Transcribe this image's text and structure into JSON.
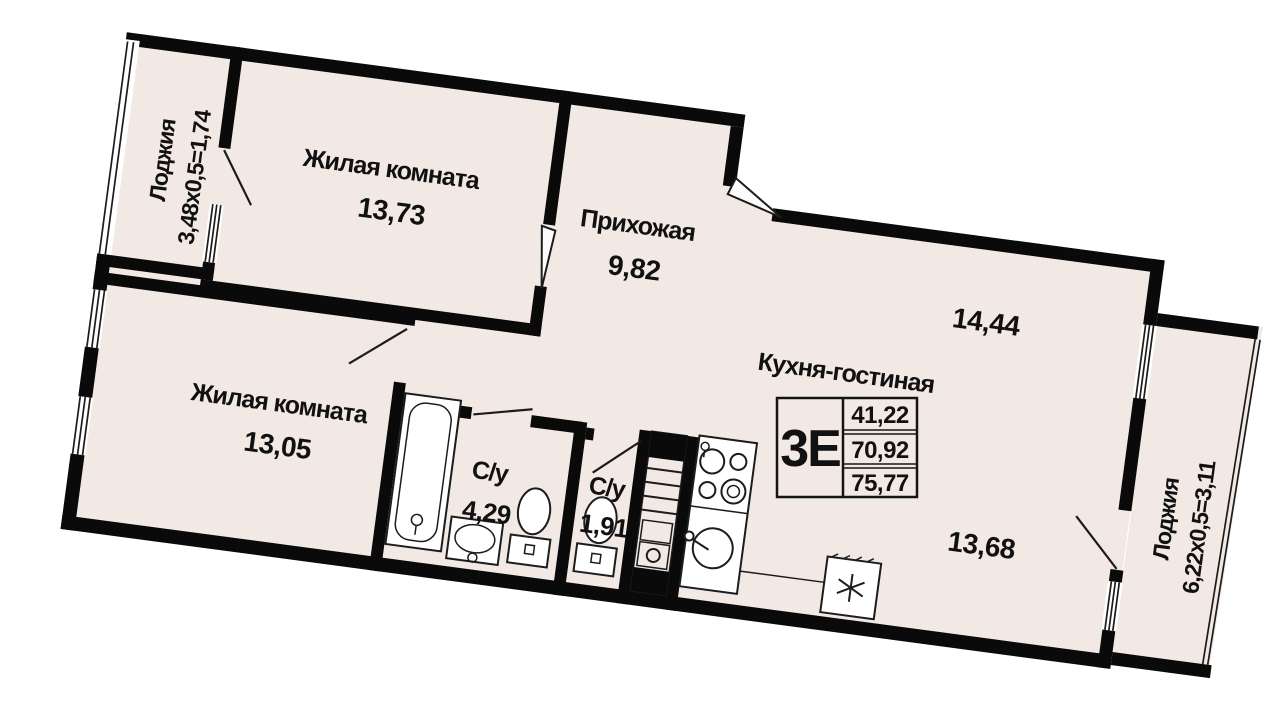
{
  "plan": {
    "rooms": {
      "living1": {
        "name": "Жилая комната",
        "area": "13,73"
      },
      "hallway": {
        "name": "Прихожая",
        "area": "9,82"
      },
      "living2": {
        "name": "Жилая комната",
        "area": "13,05"
      },
      "bath_big": {
        "name": "С/у",
        "area": "4,29"
      },
      "bath_small": {
        "name": "С/у",
        "area": "1,91"
      },
      "kitchen_living": {
        "name": "Кухня-гостиная",
        "area_upper": "14,44",
        "area_lower": "13,68"
      }
    },
    "loggias": {
      "left": {
        "name": "Лоджия",
        "formula": "3,48х0,5=1,74"
      },
      "right": {
        "name": "Лоджия",
        "formula": "6,22х0,5=3,11"
      }
    },
    "info_box": {
      "layout_type": "3Е",
      "rows": [
        "41,22",
        "70,92",
        "75,77"
      ]
    },
    "fixtures": [
      "bathtub",
      "washbasin",
      "toilet",
      "toilet",
      "stove",
      "kitchen-sink",
      "washing-machine",
      "ventilation-shaft"
    ],
    "colors": {
      "wall": "#0a0a0a",
      "floor": "#f3e9e4",
      "background": "#ffffff"
    }
  }
}
